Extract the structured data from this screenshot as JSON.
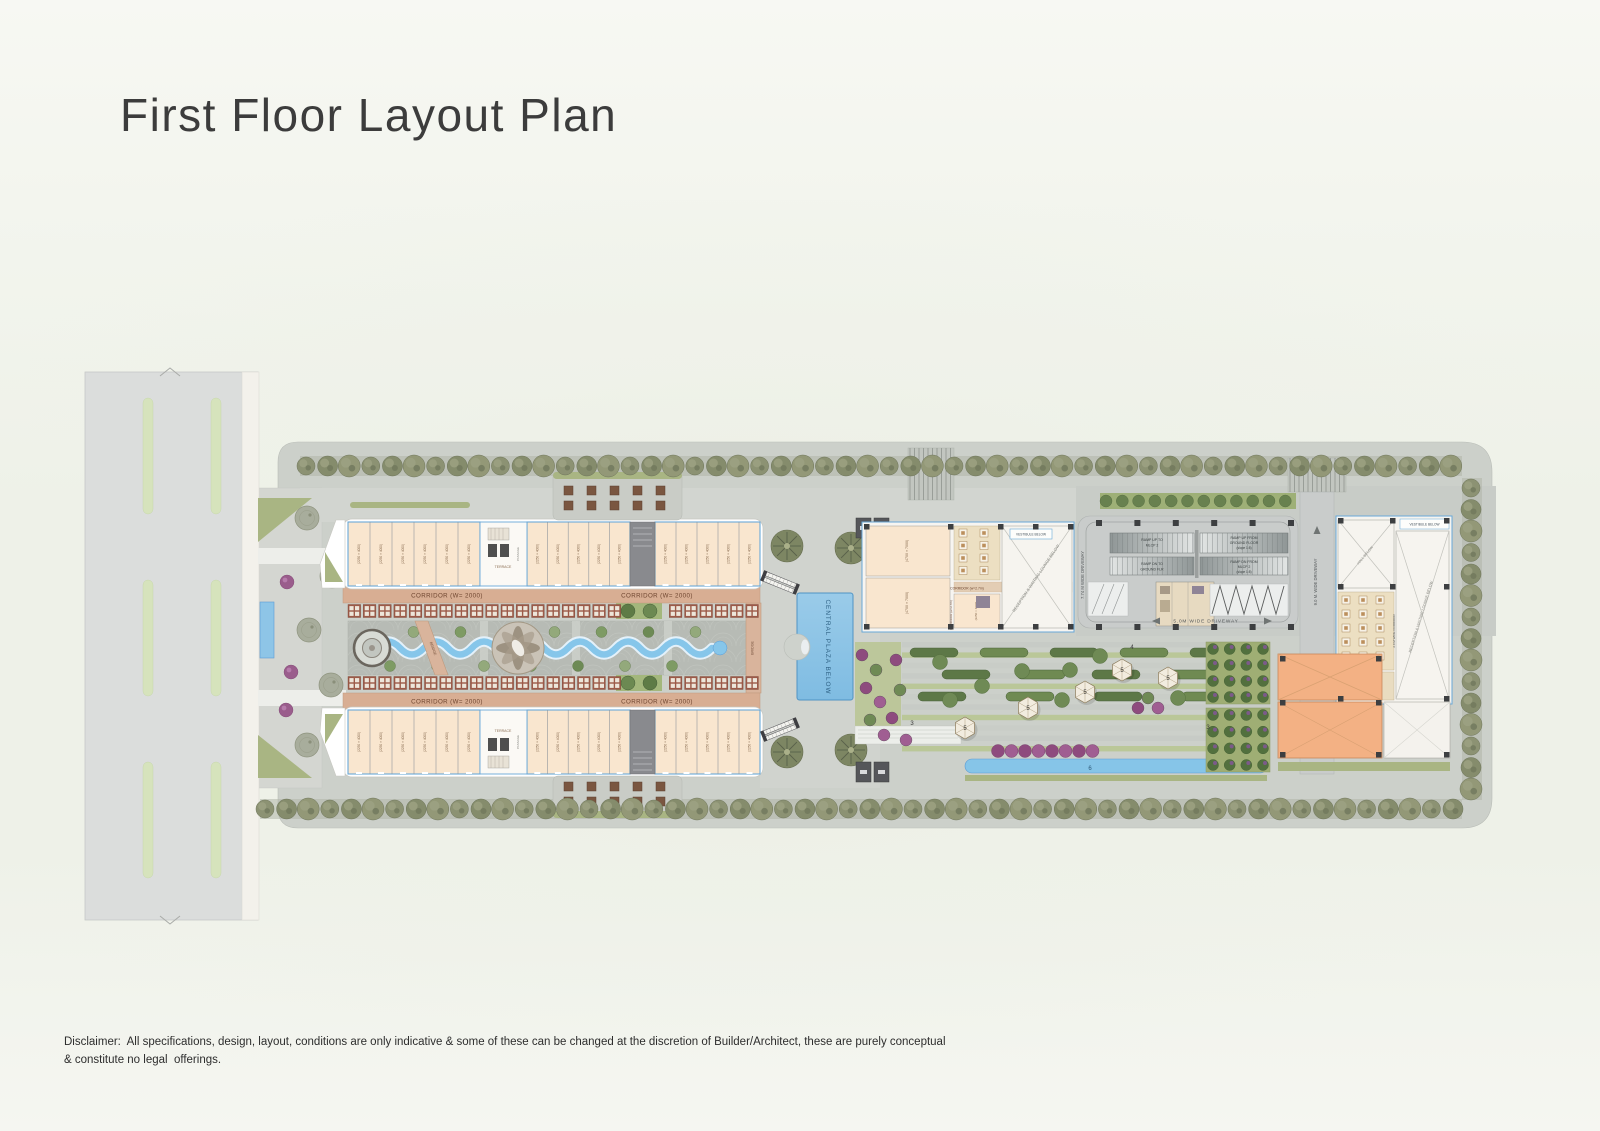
{
  "page": {
    "title": "First Floor Layout Plan",
    "disclaimer_line1": "Disclaimer:  All specifications, design, layout, conditions are only indicative & some of these can be changed at the discretion of Builder/Architect, these are purely conceptual",
    "disclaimer_line2": "& constitute no legal  offerings."
  },
  "plan": {
    "corridor_main": "CORRIDOR (W= 2000)",
    "corridor_27": "CORRIDOR (w=2.7m)",
    "corridor_20": "2.0 M WIDE CORRIDOR",
    "central_plaza": "CENTRAL PLAZA BELOW",
    "vestibule": "VESTIBULE BELOW",
    "reception": "RECEPTION & WAITING LOUNGE BELOW",
    "hall": "HALL BELOW",
    "terrace": "TERRACE",
    "bridge": "BRIDGE",
    "passage": "PASSAGE",
    "ramp_up_to_1": "RAMP UP TO",
    "ramp_up_to_2": "MLCP 2",
    "ramp_dn_to_1": "RAMP DN TO",
    "ramp_dn_to_2": "GROUND FLR",
    "ramp_up_from_1": "RAMP UP FROM",
    "ramp_up_from_2": "GROUND FLOOR",
    "ramp_up_from_3": "(slope 1:8)",
    "ramp_dn_from_1": "RAMP DN FROM",
    "ramp_dn_from_2": "MLCP 2",
    "ramp_dn_from_3": "(slope 1:8)",
    "driveway_5": "5.0M  WIDE  DRIVEWAY",
    "driveway_774": "7.74 M WIDE DRIVEWAY",
    "driveway_9": "9.0 M. WIDE DRIVEWAY",
    "marker_3": "3",
    "marker_4": "4",
    "marker_5": "5",
    "marker_6": "6",
    "unit_dim_standard": "(2250 × 4000)",
    "unit_dim_large": "(4700 × 7000)",
    "unit_bands": {
      "top_a": 6,
      "top_b": 5,
      "top_c": 5,
      "bot_a": 6,
      "bot_b": 5,
      "bot_c": 5
    },
    "icons": [
      "tree",
      "palm-tree",
      "shrub",
      "dining-table",
      "escalator",
      "lift",
      "gazebo",
      "fountain",
      "stream",
      "pool",
      "column"
    ],
    "colors": {
      "unit_fill": "#f9e6cf",
      "unit_stroke": "#69a8d8",
      "corridor_fill": "#d8ae93",
      "water": "#86c6ea",
      "orange_room": "#f3b184",
      "kiosk": "#9c5a48",
      "tree_olive": "#8c9273",
      "purple_shrub": "#8e4b7e",
      "paving": "#ced2cc",
      "road": "#dbdddc"
    }
  }
}
